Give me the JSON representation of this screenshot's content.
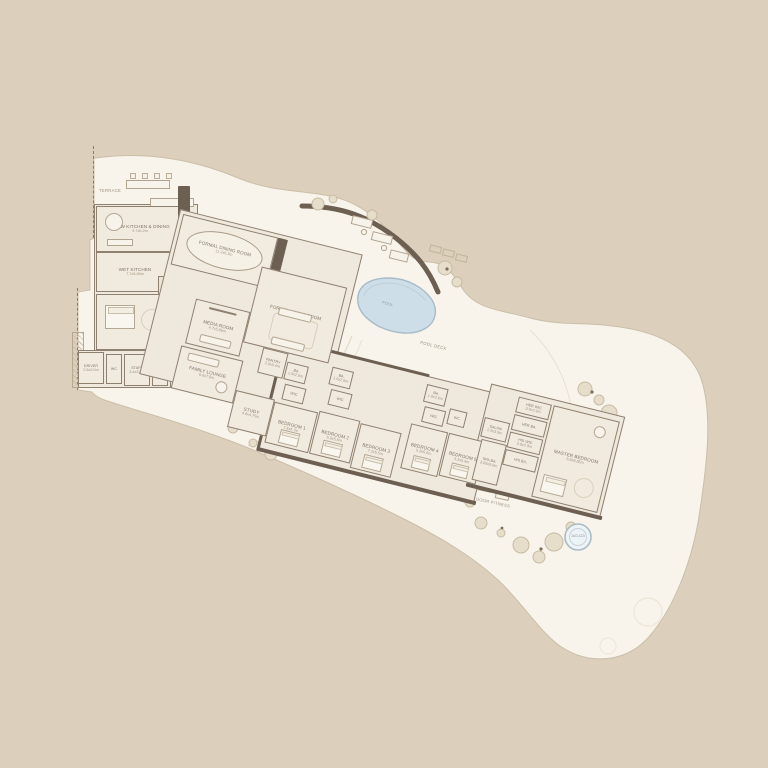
{
  "meta": {
    "type": "residential-floor-plan"
  },
  "colors": {
    "background": "#DCCFBB",
    "deck": "#F8F4EC",
    "room_fill": "#F1EADE",
    "wall": "#6D5F51",
    "pool_fill": "#CDDEE9",
    "pool_stroke": "#A8BCC8",
    "label_text": "#7F7466"
  },
  "outdoor": {
    "terrace": "TERRACE",
    "pool": "POOL",
    "pool_deck": "POOL DECK",
    "outdoor_fitness": "OUTDOOR FITNESS",
    "jacuzzi": "JACUZZI"
  },
  "rooms": {
    "show_kitchen": {
      "name": "SHOW KITCHEN & DINING",
      "dims": "9.7x6.2m"
    },
    "wet_kitchen": {
      "name": "WET KITCHEN",
      "dims": "7.7x5.85m"
    },
    "wc_lobby": {
      "name": "WC",
      "dims": "1.6x2.07m"
    },
    "lift": {
      "name": "LIFT"
    },
    "foyer": {
      "name": "FOYER",
      "dims": "5.08x3.07m"
    },
    "driver": {
      "name": "DRIVER",
      "dims": "2.6x3.0m"
    },
    "wc_a": {
      "name": "WC"
    },
    "staff": {
      "name": "STAFF",
      "dims": "3.4x3.0m"
    },
    "wc_b": {
      "name": "WC"
    },
    "laundry": {
      "name": "LAUNDRY",
      "dims": "2.6x3.0m"
    },
    "formal_dining": {
      "name": "FORMAL DINING ROOM",
      "dims": "11.2x6.3m"
    },
    "formal_living": {
      "name": "FORMAL LIVING ROOM",
      "dims": "8.9x10.35m"
    },
    "media": {
      "name": "MEDIA ROOM",
      "dims": "4.7x5.86m"
    },
    "family_lounge": {
      "name": "FAMILY LOUNGE",
      "dims": "6.6x7.9m"
    },
    "pantry": {
      "name": "PANTRY",
      "dims": "2.0x3.4m"
    },
    "study": {
      "name": "STUDY",
      "dims": "4.6x4.75m"
    },
    "ba1": {
      "name": "BA.",
      "dims": "1.9x2.6m"
    },
    "wic1": {
      "name": "WIC",
      "dims": "1.9x2.4m"
    },
    "bedroom1": {
      "name": "BEDROOM 1",
      "dims": "7.3x4.7m"
    },
    "ba2": {
      "name": "BA.",
      "dims": "1.9x2.6m"
    },
    "wic2": {
      "name": "WIC",
      "dims": "1.9x2.4m"
    },
    "bedroom2": {
      "name": "BEDROOM 2",
      "dims": "5.3x5.6m"
    },
    "bedroom3": {
      "name": "BEDROOM 3",
      "dims": "7.2x5.5m"
    },
    "ba3": {
      "name": "BA.",
      "dims": "1.9x2.6m"
    },
    "wic3": {
      "name": "WIC",
      "dims": "1.9x2.4m"
    },
    "wc_hall": {
      "name": "WC"
    },
    "bedroom4": {
      "name": "BEDROOM 4",
      "dims": "5.3x5.6m"
    },
    "bedroom5": {
      "name": "BEDROOM 5",
      "dims": "5.3x5.6m"
    },
    "salon": {
      "name": "SALON",
      "dims": "2.9x3.6m"
    },
    "spa_ba": {
      "name": "SPA BA.",
      "dims": "3.05x5.6m"
    },
    "her_wic": {
      "name": "HER WIC",
      "dims": "3.9x2.9m"
    },
    "her_ba": {
      "name": "HER BA.",
      "dims": "2.9x3.6m"
    },
    "his_wic": {
      "name": "HIS WIC",
      "dims": "3.9x2.9m"
    },
    "his_ba": {
      "name": "HIS BA.",
      "dims": "2.9x3.6m"
    },
    "master": {
      "name": "MASTER BEDROOM",
      "dims": "6.8x9.85m"
    }
  }
}
